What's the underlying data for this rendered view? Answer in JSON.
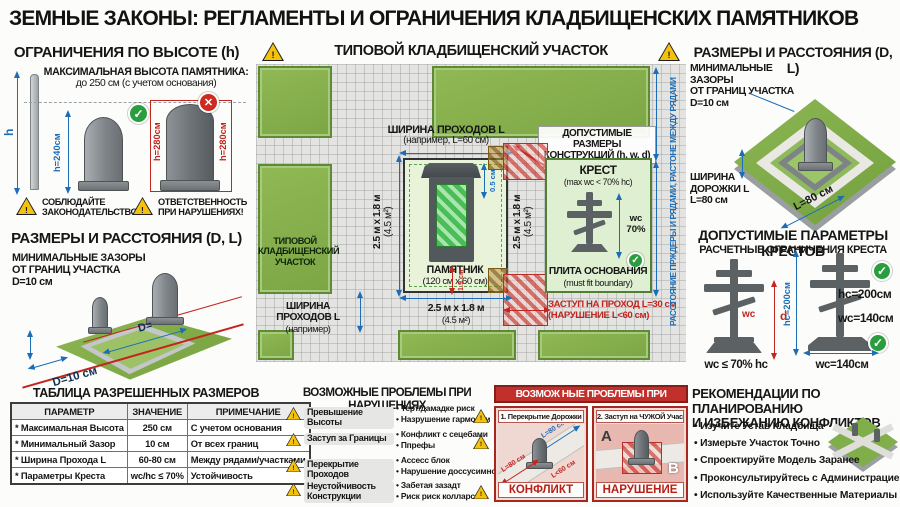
{
  "title": "ЗЕМНЫЕ ЗАКОНЫ: РЕГЛАМЕНТЫ И ОГРАНИЧЕНИЯ КЛАДБИЩЕНСКИХ ПАМЯТНИКОВ",
  "colors": {
    "accent_blue": "#1c6db5",
    "accent_red": "#c0251f",
    "grass_green": "#87b24c",
    "warning_yellow": "#f4c10f",
    "ok_green": "#2a9e3f"
  },
  "height_section": {
    "title": "ОГРАНИЧЕНИЯ ПО ВЫСОТЕ (h)",
    "subtitle": "МАКСИМАЛЬНАЯ ВЫСОТА ПАМЯТНИКА:",
    "subtitle2": "до 250 см (с учетом основания)",
    "pole_label": "h",
    "ok_height": "h=240см",
    "bad_height_left": "h=280см",
    "bad_height_right": "h=280см",
    "warning1_line1": "СОБЛЮДАЙТЕ",
    "warning1_line2": "ЗАКОНОДАТЕЛЬСТВО!",
    "warning2_line1": "ОТВЕТСТВЕННОСТЬ",
    "warning2_line2": "ПРИ НАРУШЕНИЯХ!"
  },
  "left_distances_section": {
    "title": "РАЗМЕРЫ И РАССТОЯНИЯ (D, L)",
    "note_line1": "МИНИМАЛЬНЫЕ ЗАЗОРЫ",
    "note_line2": "ОТ ГРАНИЦ УЧАСТКА",
    "note_line3": "D=10 см",
    "inner_dim": "D=",
    "outer_dim": "D=10 см"
  },
  "map_section": {
    "title": "ТИПОВОЙ КЛАДБИЩЕНСКИЙ УЧАСТОК",
    "left_plot_line1": "ТИПОВОЙ",
    "left_plot_line2": "КЛАДБИЩЕНСКИЙ",
    "left_plot_line3": "УЧАСТОК",
    "path_top_line1": "ШИРИНА ПРОХОДОВ L",
    "path_top_line2": "(например, L=60 см)",
    "allowed_line1": "ДОПУСТИМЫЕ РАЗМЕРЫ",
    "allowed_line2": "КОНСТРУКЦИЙ (h, w, d)",
    "plot_size_left": "2.5 м x 1.8 м",
    "plot_size_left2": "(4.5 м²)",
    "plot_size_right": "2.5 м x 1.8 м",
    "plot_size_right2": "(4.5 м²)",
    "monument_line1": "ПАМЯТНИК",
    "monument_line2": "(120 см x 60 см)",
    "dim_small_top": "0.5 см",
    "dim_small_bottom": "1.9 см",
    "cross_title": "КРЕСТ",
    "cross_formula": "(max wc < 70% hc)",
    "cross_dim_line1": "wc",
    "cross_dim_line2": "70%",
    "base_line1": "ПЛИТА ОСНОВАНИЯ",
    "base_line2": "(must fit boundary)",
    "path_bottom_line1": "ШИРИНА ПРОХОДОВ L",
    "path_bottom_line2": "(например)",
    "size_bottom": "2.5 м x 1.8 м",
    "size_bottom2": "(4.5 м²)",
    "violation_line1": "ЗАСТУП НА ПРОХОД L=30 см",
    "violation_line2": "(НАРУШЕНИЕ L<60 см)",
    "right_vertical_label": "РАССТОЯНИЕ ПРЖДЕРЫ И РЯДАМИ, РАСТОНЕ МЕЖДУ РЯДАМИ"
  },
  "right_distances_section": {
    "title": "РАЗМЕРЫ И РАССТОЯНИЯ (D, L)",
    "note_line1": "МИНИМАЛЬНЫЕ ЗАЗОРЫ",
    "note_line2": "ОТ ГРАНИЦ УЧАСТКА",
    "note_line3": "D=10 см",
    "path_line1": "ШИРИНА",
    "path_line2": "ДОРОЖКИ L",
    "path_line3": "L=80 см",
    "diagonal_dim": "L=80 см"
  },
  "crosses_section": {
    "title": "ДОПУСТИМЫЕ ПАРАМЕТРЫ КРЕСТОВ",
    "subtitle": "РАСЧЕТНЫЕ ОГРАНИЧЕНИЯ КРЕСТА",
    "wc_label": "wc",
    "d_label": "d",
    "left_formula": "wc ≤ 70% hc",
    "hc_vertical": "hc=200см",
    "hc_value": "hc=200см",
    "wc_value": "wc=140см",
    "base_width": "wc=140см"
  },
  "table_section": {
    "title": "ТАБЛИЦА РАЗРЕШЕННЫХ РАЗМЕРОВ",
    "headers": [
      "ПАРАМЕТР",
      "ЗНАЧЕНИЕ",
      "ПРИМЕЧАНИЕ"
    ],
    "rows": [
      [
        "* Максимальная Высота",
        "250 см",
        "С учетом основания"
      ],
      [
        "* Минимальный Зазор",
        "10 см",
        "От всех границ"
      ],
      [
        "* Ширина Прохода L",
        "60-80 см",
        "Между рядами/участками"
      ],
      [
        "* Параметры Креста",
        "wc/hc ≤ 70%",
        "Устойчивость"
      ]
    ]
  },
  "problems_section": {
    "title": "ВОЗМОЖНЫЕ ПРОБЛЕМЫ ПРИ НАРУШЕНИЯХ",
    "items": [
      {
        "label": "Превышение Высоты",
        "bullet1": "Терт/дамадке риск",
        "bullet2": "Назрушение гармонии"
      },
      {
        "label": "Заступ за Границы",
        "bullet1": "Конфликт с сецебами",
        "bullet2": "Ппрефы"
      },
      {
        "label": "Перекрытие Проходов",
        "bullet1": "Ассесс блок",
        "bullet2": "Нарушение доссусимности"
      },
      {
        "label": "Неустойчивость Конструкции",
        "bullet1": "Забетая зазадт",
        "bullet2": "Риск риск колларсы"
      }
    ]
  },
  "violations_panel": {
    "title": "ВОЗМОЖ НЫЕ ПРОБЛЕМЫ ПРИ НАРУШЕНИХ",
    "card1_title": "1. Перекрытие Дорожки",
    "card1_dim_blue": "L=80 см",
    "card1_dim_red1": "L=80 см",
    "card1_dim_red2": "L<60 см",
    "card1_footer": "КОНФЛИКТ",
    "card2_title": "2. Заступ на ЧУЖОЙ Участок",
    "card2_label_a": "A",
    "card2_label_b": "B",
    "card2_footer": "НАРУШЕНИЕ"
  },
  "recommendations_section": {
    "title_line1": "РЕКОМЕНДАЦИИ ПО ПЛАНИРОВАНИЮ",
    "title_line2": "И ИЗБЕЖАНИЮ КОНФЛИКТОВ",
    "items": [
      "Изучите Устав Кладбища",
      "Измерьте Участок Точно",
      "Спроектируйте Модель Заранее",
      "Проконсультируйтесь с Администрацией",
      "Используйте Качественные Материалы"
    ]
  }
}
